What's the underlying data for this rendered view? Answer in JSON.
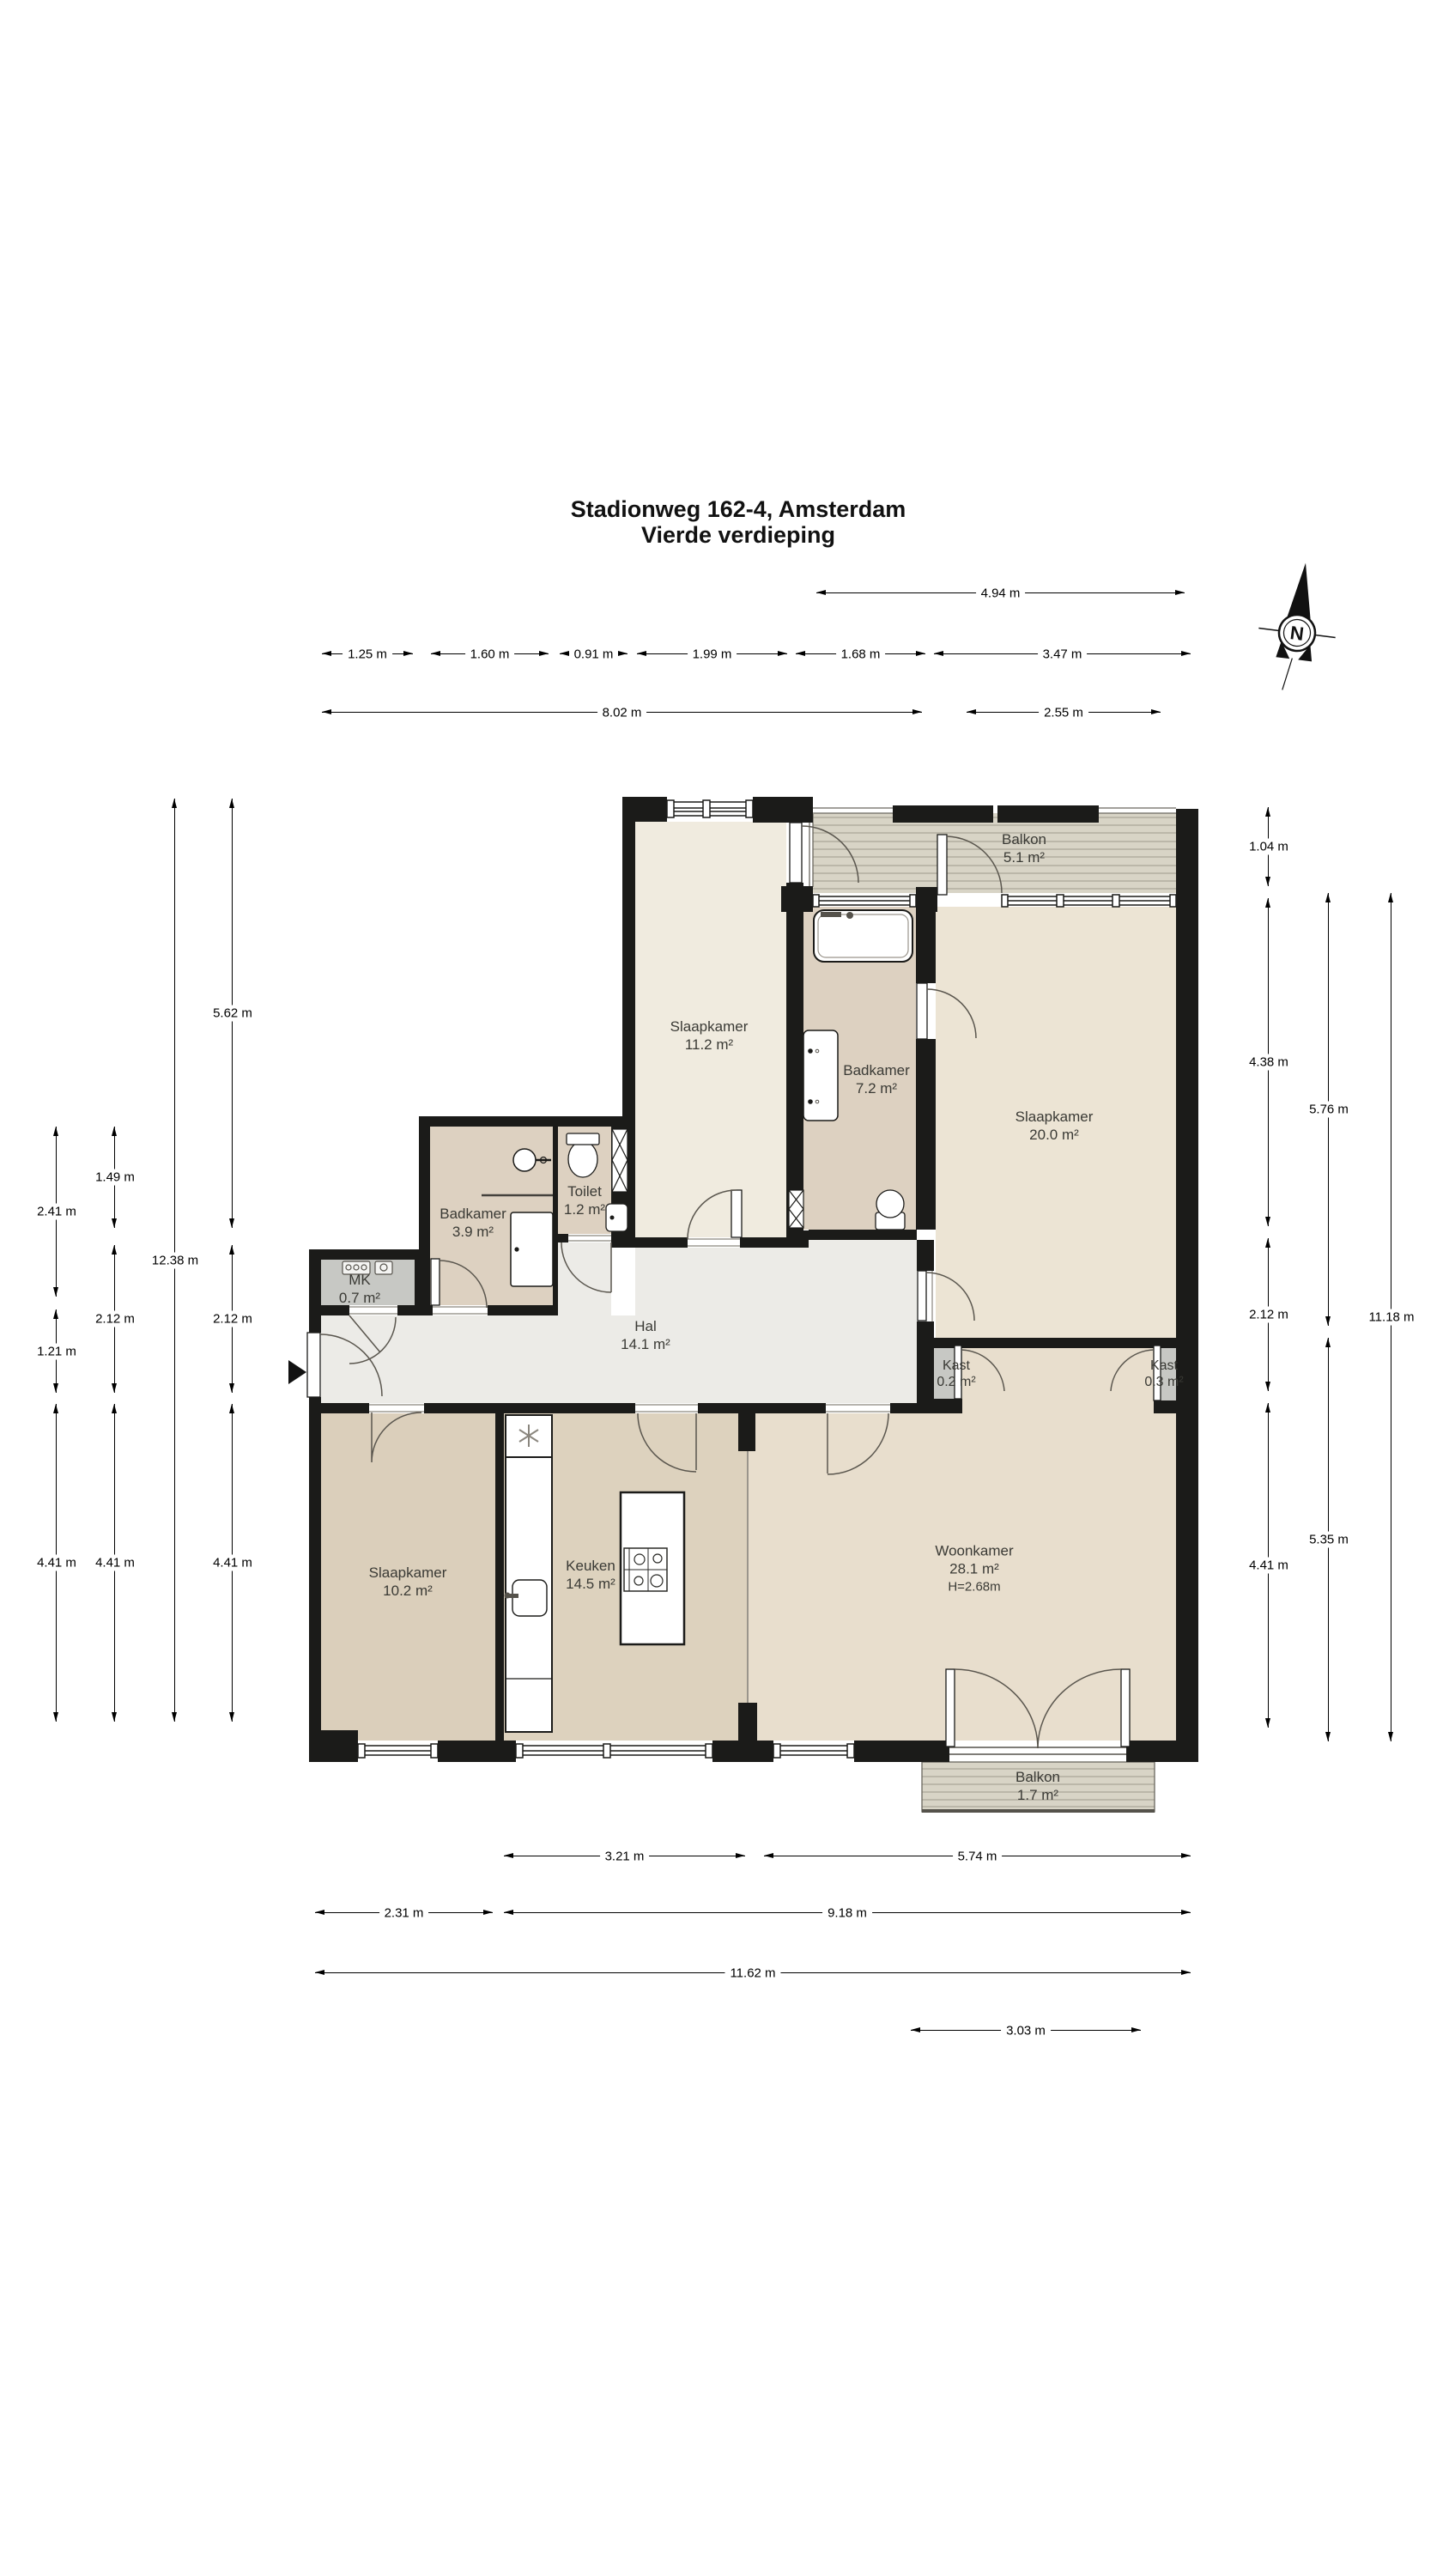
{
  "title": {
    "line1": "Stadionweg 162-4, Amsterdam",
    "line2": "Vierde verdieping"
  },
  "compass": {
    "label": "N"
  },
  "rooms": {
    "balkon_noord": {
      "name": "Balkon",
      "area": "5.1 m²"
    },
    "slaapkamer_noord": {
      "name": "Slaapkamer",
      "area": "11.2 m²"
    },
    "badkamer_groot": {
      "name": "Badkamer",
      "area": "7.2 m²"
    },
    "slaapkamer_oost": {
      "name": "Slaapkamer",
      "area": "20.0 m²"
    },
    "toilet": {
      "name": "Toilet",
      "area": "1.2 m²"
    },
    "badkamer_klein": {
      "name": "Badkamer",
      "area": "3.9 m²"
    },
    "mk": {
      "name": "MK",
      "area": "0.7 m²"
    },
    "hal": {
      "name": "Hal",
      "area": "14.1 m²"
    },
    "kast_links": {
      "name": "Kast",
      "area": "0.2 m²"
    },
    "kast_rechts": {
      "name": "Kast",
      "area": "0.3 m²"
    },
    "slaapkamer_zuid": {
      "name": "Slaapkamer",
      "area": "10.2 m²"
    },
    "keuken": {
      "name": "Keuken",
      "area": "14.5 m²"
    },
    "woonkamer": {
      "name": "Woonkamer",
      "area": "28.1 m²",
      "ceiling": "H=2.68m"
    },
    "balkon_zuid": {
      "name": "Balkon",
      "area": "1.7 m²"
    }
  },
  "dimensions": {
    "top": {
      "d494": "4.94 m",
      "d125": "1.25 m",
      "d160": "1.60 m",
      "d091": "0.91 m",
      "d199": "1.99 m",
      "d168": "1.68 m",
      "d347": "3.47 m",
      "d802": "8.02 m",
      "d255": "2.55 m"
    },
    "left": {
      "d241": "2.41 m",
      "d121": "1.21 m",
      "d441a": "4.41 m",
      "d149": "1.49 m",
      "d212a": "2.12 m",
      "d441b": "4.41 m",
      "d1238": "12.38 m",
      "d562": "5.62 m",
      "d212b": "2.12 m",
      "d441c": "4.41 m"
    },
    "right": {
      "d104": "1.04 m",
      "d438": "4.38 m",
      "d212": "2.12 m",
      "d441": "4.41 m",
      "d576": "5.76 m",
      "d535": "5.35 m",
      "d1118": "11.18 m"
    },
    "bottom": {
      "d321": "3.21 m",
      "d574": "5.74 m",
      "d231": "2.31 m",
      "d918": "9.18 m",
      "d1162": "11.62 m",
      "d303": "3.03 m"
    }
  }
}
